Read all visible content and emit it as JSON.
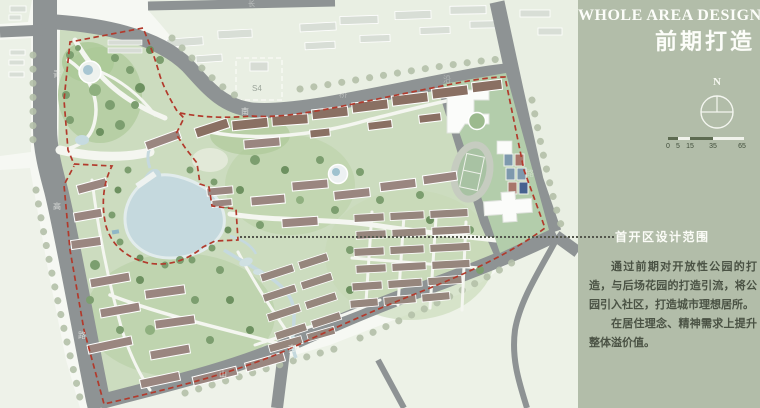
{
  "panel": {
    "title_en": "WHOLE AREA DESIGN",
    "title_cn": "前期打造",
    "compass": {
      "north_label": "N"
    },
    "scale_bar": {
      "ticks": [
        "0",
        "5",
        "15",
        "35",
        "65"
      ]
    },
    "callout": {
      "label": "首开区设计范围"
    },
    "paragraphs": {
      "p1": "通过前期对开放性公园的打造，与后场花园的打造引流，将公园引入社区，打造城市理想居所。",
      "p2": "在居住理念、精神需求上提升整体溢价值。"
    },
    "colors": {
      "background": "#b2bda9",
      "text_dark": "#4a5244",
      "text_light": "#fcfdf9"
    }
  },
  "map": {
    "parcel_label": "S4",
    "road_labels": [
      {
        "text": "长"
      },
      {
        "text": "青"
      },
      {
        "text": "高"
      },
      {
        "text": "路"
      },
      {
        "text": "南"
      },
      {
        "text": "桥"
      },
      {
        "text": "沿"
      },
      {
        "text": "路"
      },
      {
        "text": "杏"
      },
      {
        "text": "山"
      }
    ],
    "colors": {
      "road": "#8e9394",
      "water": "#c5d9de",
      "boundary_red": "#b23a2c",
      "site_green": "#ccdcbf",
      "block_green": "#e9efe3",
      "building_roof": "#9a8680",
      "school_green": "#b3cdab"
    }
  }
}
